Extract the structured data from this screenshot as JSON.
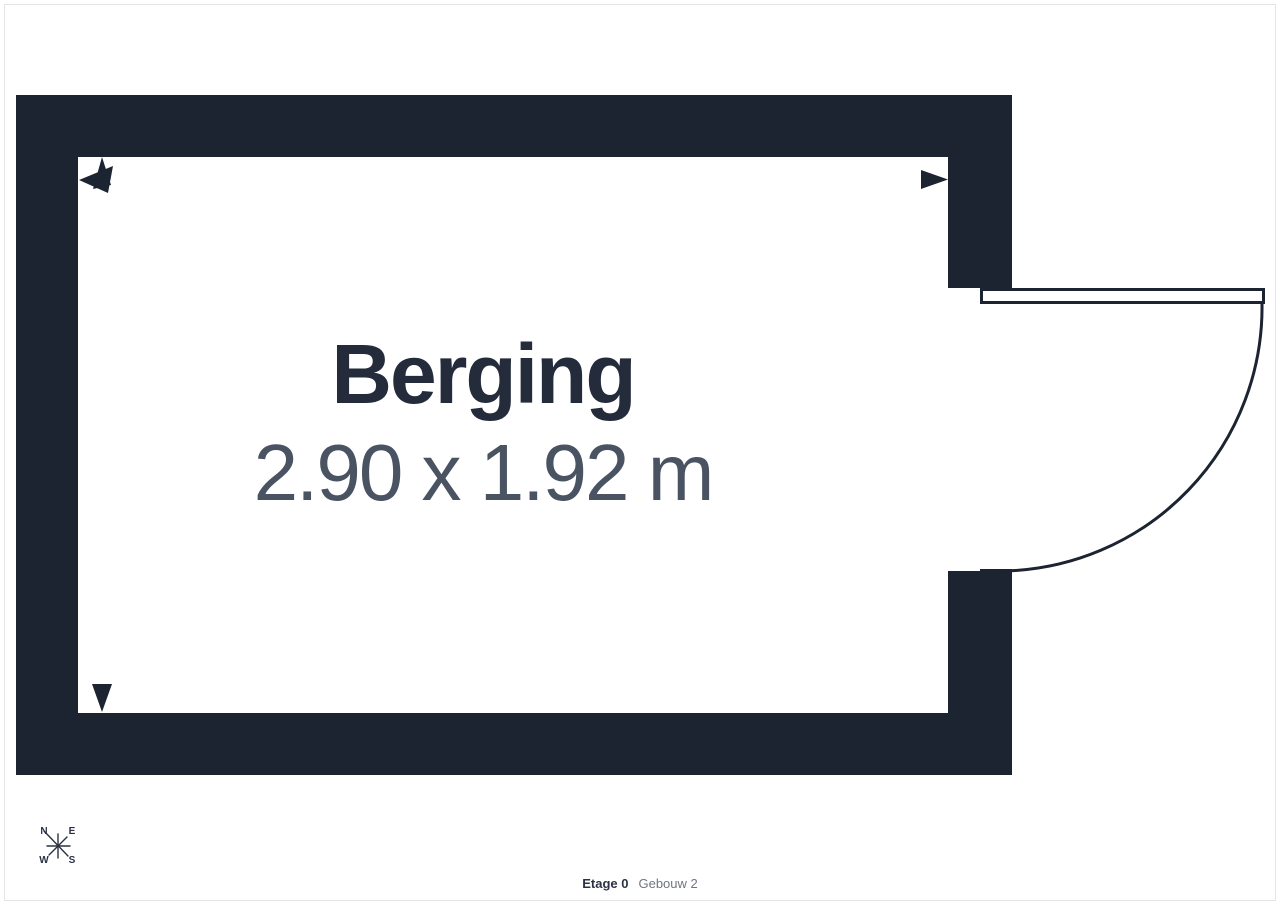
{
  "room": {
    "name": "Berging",
    "dimensions": "2.90 x 1.92 m"
  },
  "compass": {
    "n": "N",
    "e": "E",
    "w": "W",
    "s": "S"
  },
  "footer": {
    "floor": "Etage 0",
    "building": "Gebouw 2"
  },
  "colors": {
    "wall": "#1c2331",
    "room_name": "#242c3b",
    "dimensions_text": "#4a5362",
    "footer_floor": "#2b3342",
    "footer_building": "#6f7582",
    "frame_border": "#e3e5e8",
    "background": "#ffffff"
  }
}
